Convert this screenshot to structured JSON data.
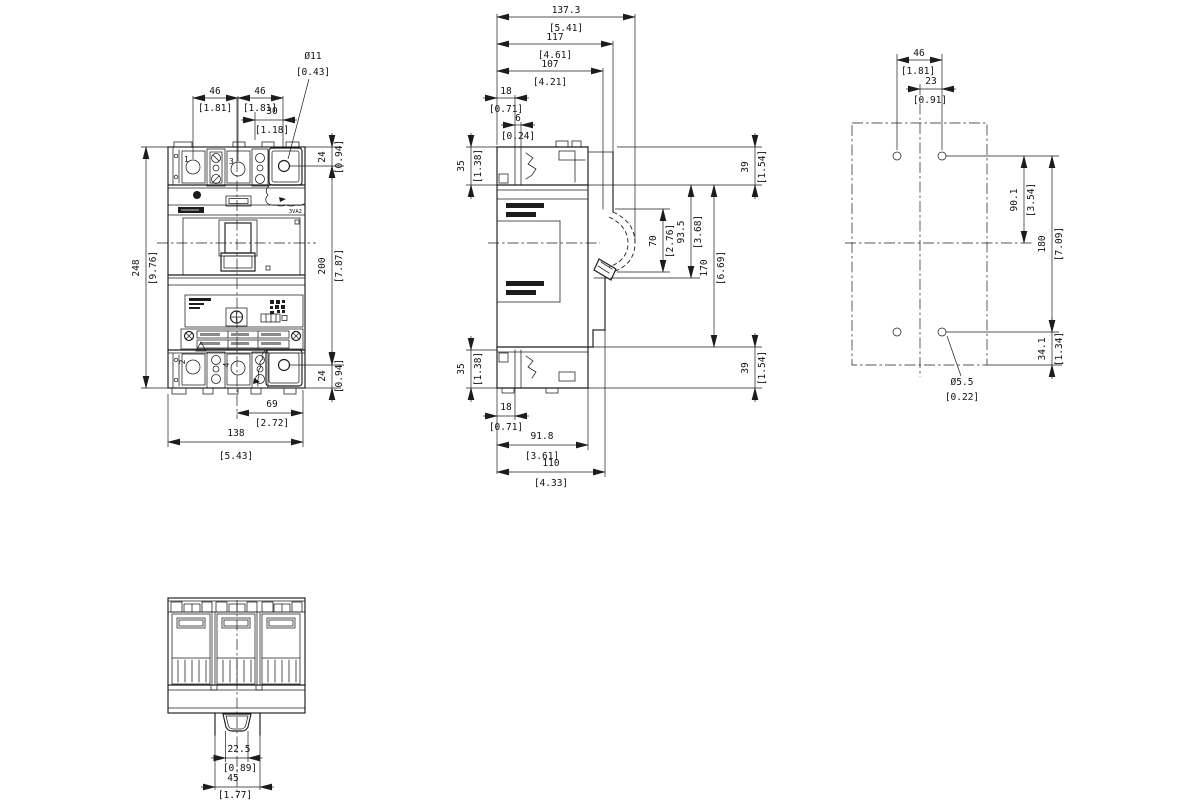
{
  "front": {
    "poles": {
      "p1": "1",
      "p3": "3",
      "p2": "2",
      "p4": "4"
    },
    "product": "3VA2",
    "dims": {
      "pitch_a": {
        "mm": "46",
        "in": "[1.81]"
      },
      "pitch_b": {
        "mm": "46",
        "in": "[1.81]"
      },
      "hole_off": {
        "mm": "30",
        "in": "[1.18]"
      },
      "hole_dia": {
        "mm": "Ø11",
        "in": "[0.43]"
      },
      "height": {
        "mm": "248",
        "in": "[9.76]"
      },
      "span": {
        "mm": "200",
        "in": "[7.87]"
      },
      "top24": {
        "mm": "24",
        "in": "[0.94]"
      },
      "bot24": {
        "mm": "24",
        "in": "[0.94]"
      },
      "half": {
        "mm": "69",
        "in": "[2.72]"
      },
      "width": {
        "mm": "138",
        "in": "[5.43]"
      }
    }
  },
  "side": {
    "dims": {
      "total": {
        "mm": "137.3",
        "in": "[5.41]"
      },
      "esc": {
        "mm": "117",
        "in": "[4.61]"
      },
      "cover": {
        "mm": "107",
        "in": "[4.21]"
      },
      "term_top": {
        "mm": "18",
        "in": "[0.71]"
      },
      "gap": {
        "mm": "6",
        "in": "[0.24]"
      },
      "t35_top": {
        "mm": "35",
        "in": "[1.38]"
      },
      "t35_bot": {
        "mm": "35",
        "in": "[1.38]"
      },
      "z39_top": {
        "mm": "39",
        "in": "[1.54]"
      },
      "z39_bot": {
        "mm": "39",
        "in": "[1.54]"
      },
      "travel": {
        "mm": "70",
        "in": "[2.76]"
      },
      "front_h": {
        "mm": "93.5",
        "in": "[3.68]"
      },
      "body_h": {
        "mm": "170",
        "in": "[6.69]"
      },
      "term_bot": {
        "mm": "18",
        "in": "[0.71]"
      },
      "base": {
        "mm": "91.8",
        "in": "[3.61]"
      },
      "depth110": {
        "mm": "110",
        "in": "[4.33]"
      }
    }
  },
  "drill": {
    "dims": {
      "pitch": {
        "mm": "46",
        "in": "[1.81]"
      },
      "half": {
        "mm": "23",
        "in": "[0.91]"
      },
      "upper": {
        "mm": "90.1",
        "in": "[3.54]"
      },
      "span": {
        "mm": "180",
        "in": "[7.09]"
      },
      "lower": {
        "mm": "34.1",
        "in": "[1.34]"
      },
      "dia": {
        "mm": "Ø5.5",
        "in": "[0.22]"
      }
    }
  },
  "bottom": {
    "dims": {
      "cutout": {
        "mm": "22.5",
        "in": "[0.89]"
      },
      "esc": {
        "mm": "45",
        "in": "[1.77]"
      }
    }
  }
}
